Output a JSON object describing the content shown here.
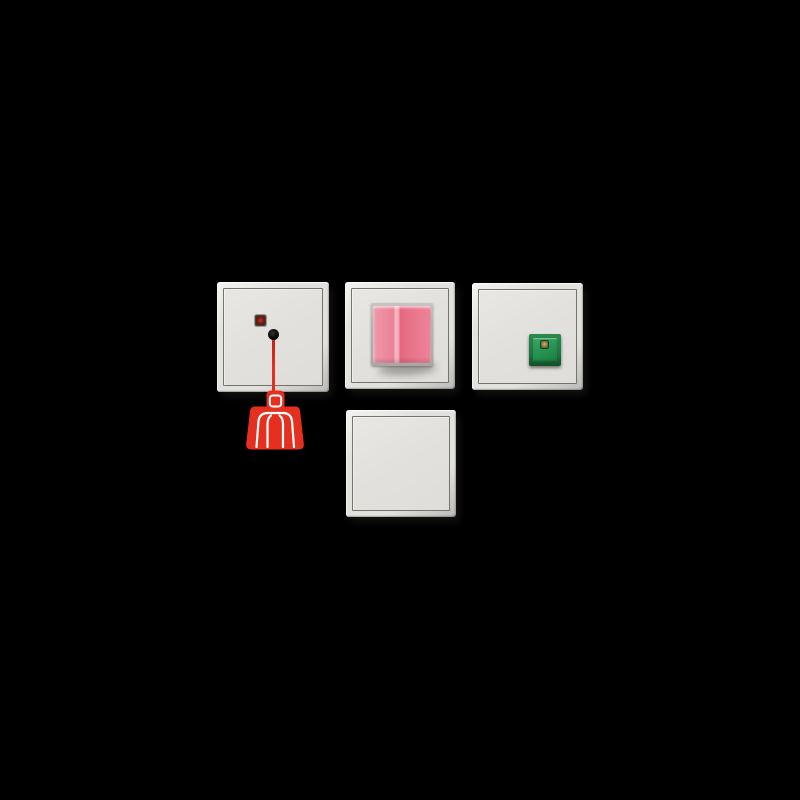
{
  "scene": {
    "type": "product-photo",
    "description": "Four square wall-switch modules of a call/signal system arranged on a black background: a pull-cord call switch with red LED and red person-pictogram pull handle (top-left), a switch with an oversized pink rocker (top-center), a plate with a green cancel push-button with amber LED (top-right), and a blank cover plate (bottom-center)."
  },
  "colors": {
    "background": "#000000",
    "plate": "#e2e1dd",
    "plate_highlight": "#f4f3ef",
    "plate_shadow": "#bbbab6",
    "frame_line": "#74736c",
    "signal_red": "#e6301f",
    "signal_red_dark": "#c02217",
    "led_red": "#5a1811",
    "pictogram_white": "#ffffff",
    "pink_light": "#f097a9",
    "pink_mid": "#e98197",
    "pink_dark": "#e4677f",
    "pink_highlight": "#f6bac6",
    "green_frame": "#1c7340",
    "green_button": "#249350",
    "led_amber": "#9a8448",
    "clip_gray": "#b7b6b2"
  },
  "modules": [
    {
      "name": "pull-cord call switch",
      "position": "top-left",
      "features": [
        "red indicator LED",
        "cord outlet hole",
        "red pull cord",
        "red pull handle with white person pictogram"
      ]
    },
    {
      "name": "pink rocker switch",
      "position": "top-center",
      "features": [
        "oversized protruding pink rocker on gray mounting frame"
      ]
    },
    {
      "name": "green cancel button plate",
      "position": "top-right",
      "features": [
        "green square push-button with amber indicator LED"
      ]
    },
    {
      "name": "blank cover plate",
      "position": "bottom-center",
      "features": []
    }
  ],
  "icons": {
    "person_pictogram": "white outline of a person (head and torso with arms) on the red pull handle"
  }
}
